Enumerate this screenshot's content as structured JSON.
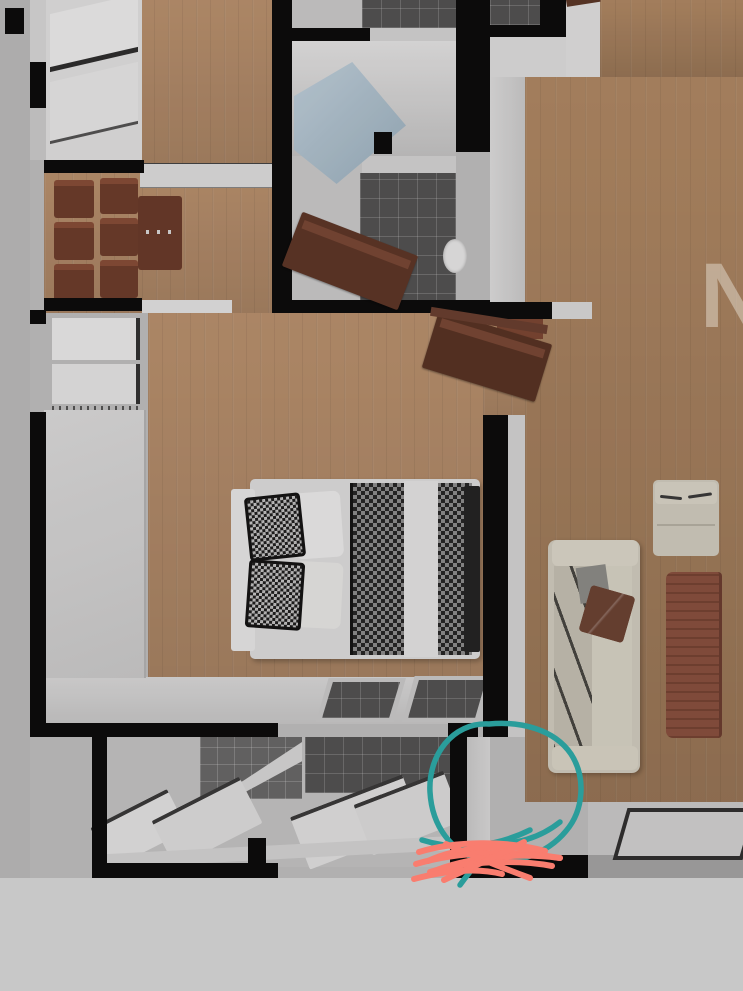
{
  "scene": {
    "kind": "3d-apartment-floor-plan-render",
    "watermark_text": "N"
  },
  "colors": {
    "background": "#c3c3c3",
    "outer_bottom": "#c8c8c8",
    "outer_left": "#bfbfbf",
    "wall": "#0c0c0c",
    "white_wall": "#dfdfdf",
    "wood_light": "#bd9470",
    "wood_right": "#b78e68",
    "tile_dark": "#545454",
    "tile_mid": "#6a6a6a",
    "shower_glass": "#b7cbd8",
    "door_brown": "#5f3728",
    "chair_brown": "#6f3e2c",
    "table_brown": "#8c5240",
    "sofa_beige": "#d5d1c3",
    "pillow_brown": "#6e4434",
    "bed_sheet": "#e2e2e2",
    "blanket_dark": "#1f1f1f",
    "annotation_teal": "#2a9d9b",
    "annotation_red": "#f97d6f",
    "watermark": "rgba(246,236,221,0.55)"
  },
  "annotations": {
    "circle": {
      "shape": "freehand-circle",
      "color": "#2a9d9b"
    },
    "scribble": {
      "shape": "freehand-scribble",
      "color": "#f97d6f"
    }
  }
}
